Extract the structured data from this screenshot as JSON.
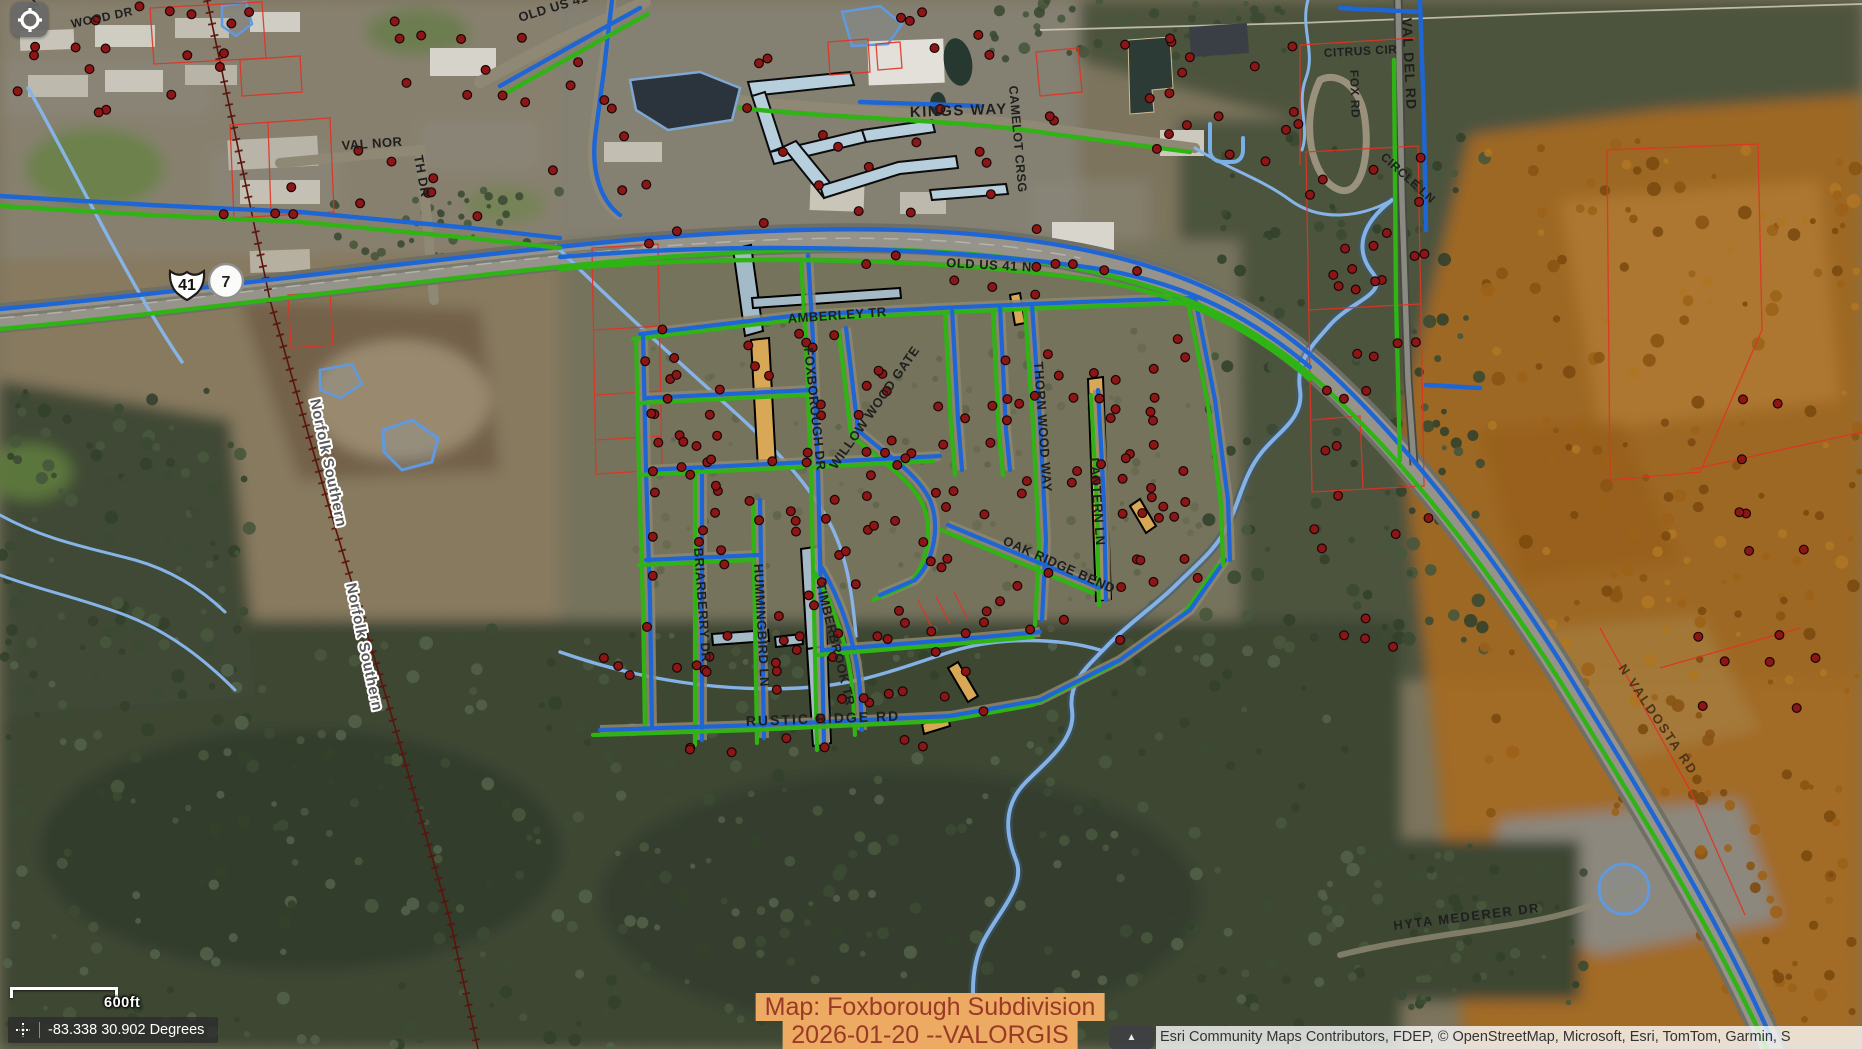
{
  "ui": {
    "locate_button": {
      "icon": "locate-crosshair-icon"
    },
    "scale_bar": {
      "label": "600ft"
    },
    "coordinates": {
      "icon": "crosshair-icon",
      "text": "-83.338 30.902 Degrees"
    },
    "map_stamp": {
      "line1": "Map: Foxborough Subdivision",
      "line2": "2026-01-20 --VALORGIS",
      "bg_color": "#edaa63",
      "text_color": "#9a3928"
    },
    "attribution": {
      "text": "Esri Community Maps Contributors, FDEP, © OpenStreetMap, Microsoft, Esri, TomTom, Garmin, S",
      "toggle_icon": "collapse-arrow-icon"
    }
  },
  "map": {
    "colors": {
      "parcel_red": "#e03324",
      "utility_blue": "#1e66d6",
      "utility_green": "#2fb315",
      "creek_blue": "#84b2e6",
      "address_dot": "#8c1616",
      "orange_zone": "#c67f28",
      "label": "#1f1f1f",
      "railroad": "#5a140e"
    },
    "shields": [
      {
        "type": "us-route-shield",
        "label": "41",
        "x": 187,
        "y": 284
      },
      {
        "type": "state-route-circle",
        "label": "7",
        "x": 226,
        "y": 281
      }
    ],
    "labels": [
      {
        "t": "KW",
        "x": 28,
        "y": 20,
        "r": -55,
        "s": 12
      },
      {
        "t": "WOOD DR",
        "x": 72,
        "y": 28,
        "r": -12,
        "s": 12
      },
      {
        "t": "OLD US 41 N",
        "x": 520,
        "y": 22,
        "r": -17,
        "s": 13
      },
      {
        "t": "VAL NOR",
        "x": 342,
        "y": 150,
        "r": -4,
        "s": 13
      },
      {
        "t": "TH DR",
        "x": 414,
        "y": 156,
        "r": 80,
        "s": 13
      },
      {
        "t": "KINGS WAY",
        "x": 910,
        "y": 117,
        "r": -2,
        "s": 15,
        "sp": 1.5
      },
      {
        "t": "CAMELOT CRSG",
        "x": 1009,
        "y": 86,
        "r": 85,
        "s": 12.5
      },
      {
        "t": "OLD US 41 N",
        "x": 946,
        "y": 267,
        "r": 3,
        "s": 13
      },
      {
        "t": "AMBERLEY TR",
        "x": 788,
        "y": 323,
        "r": -4,
        "s": 13
      },
      {
        "t": "FOXBOROUGH DR",
        "x": 804,
        "y": 348,
        "r": 84,
        "s": 13
      },
      {
        "t": "WILLOW WOOD GATE",
        "x": 836,
        "y": 470,
        "r": -55,
        "s": 13
      },
      {
        "t": "THORN WOOD WAY",
        "x": 1034,
        "y": 362,
        "r": 86,
        "s": 13
      },
      {
        "t": "LANTERN LN",
        "x": 1090,
        "y": 458,
        "r": 86,
        "s": 13
      },
      {
        "t": "OAK RIDGE BEND",
        "x": 1002,
        "y": 544,
        "r": 24,
        "s": 13
      },
      {
        "t": "RUSTIC RIDGE RD",
        "x": 746,
        "y": 726,
        "r": -2,
        "s": 14,
        "sp": 2
      },
      {
        "t": "BRIARBERRY DR",
        "x": 694,
        "y": 548,
        "r": 86,
        "s": 13
      },
      {
        "t": "HUMMINGBIRD LN",
        "x": 754,
        "y": 564,
        "r": 87,
        "s": 13
      },
      {
        "t": "TIMBERBROOK TR",
        "x": 816,
        "y": 584,
        "r": 76,
        "s": 13
      },
      {
        "t": "VAL DEL RD",
        "x": 1402,
        "y": 18,
        "r": 87,
        "s": 14,
        "sp": 1
      },
      {
        "t": "CITRUS CIR",
        "x": 1324,
        "y": 57,
        "r": -3,
        "s": 12
      },
      {
        "t": "FOX RD",
        "x": 1350,
        "y": 70,
        "r": 88,
        "s": 12
      },
      {
        "t": "CIRCLE LN",
        "x": 1380,
        "y": 158,
        "r": 42,
        "s": 12
      },
      {
        "t": "N VALDOSTA RD",
        "x": 1618,
        "y": 668,
        "r": 56,
        "s": 13,
        "sp": 2,
        "c": "#4d3318"
      },
      {
        "t": "HYTA MEDERER DR",
        "x": 1394,
        "y": 930,
        "r": -7,
        "s": 13,
        "sp": 1.5
      },
      {
        "t": "Norfolk Southern",
        "x": 310,
        "y": 400,
        "r": 78,
        "s": 15,
        "c": "#5a5a5a",
        "halo": true
      },
      {
        "t": "Norfolk Southern",
        "x": 346,
        "y": 584,
        "r": 78,
        "s": 15,
        "c": "#5a5a5a",
        "halo": true
      }
    ],
    "dot_zones": [
      {
        "x": 630,
        "y": 325,
        "w": 570,
        "h": 330,
        "n": 150,
        "seed": 11
      },
      {
        "x": 600,
        "y": 655,
        "w": 420,
        "h": 100,
        "n": 28,
        "seed": 22
      },
      {
        "x": 10,
        "y": 5,
        "w": 200,
        "h": 115,
        "n": 14,
        "seed": 33
      },
      {
        "x": 215,
        "y": 10,
        "w": 340,
        "h": 215,
        "n": 26,
        "seed": 44
      },
      {
        "x": 570,
        "y": 10,
        "w": 520,
        "h": 240,
        "n": 34,
        "seed": 55
      },
      {
        "x": 1090,
        "y": 35,
        "w": 210,
        "h": 130,
        "n": 18,
        "seed": 66
      },
      {
        "x": 1305,
        "y": 150,
        "w": 125,
        "h": 400,
        "n": 30,
        "seed": 77
      },
      {
        "x": 1690,
        "y": 380,
        "w": 165,
        "h": 330,
        "n": 14,
        "seed": 88
      },
      {
        "x": 1340,
        "y": 615,
        "w": 60,
        "h": 50,
        "n": 4,
        "seed": 99
      },
      {
        "x": 860,
        "y": 255,
        "w": 300,
        "h": 60,
        "n": 10,
        "seed": 12
      }
    ],
    "tree_zones": [
      {
        "x": 0,
        "y": 628,
        "w": 1360,
        "h": 420,
        "n": 420,
        "seed": 5,
        "rmin": 2.5,
        "rmax": 7,
        "colors": [
          "#3c4a33",
          "#47573c",
          "#33412b",
          "#52614a"
        ]
      },
      {
        "x": 1190,
        "y": 130,
        "w": 300,
        "h": 520,
        "n": 150,
        "seed": 6,
        "rmin": 2.5,
        "rmax": 7,
        "colors": [
          "#3c4a33",
          "#47573c",
          "#33412b"
        ]
      },
      {
        "x": 0,
        "y": 390,
        "w": 250,
        "h": 320,
        "n": 110,
        "seed": 7,
        "rmin": 2.5,
        "rmax": 7,
        "colors": [
          "#3c4a33",
          "#47573c",
          "#33412b"
        ]
      },
      {
        "x": 980,
        "y": 0,
        "w": 360,
        "h": 60,
        "n": 60,
        "seed": 8,
        "rmin": 2.5,
        "rmax": 6,
        "colors": [
          "#3c4a33",
          "#47573c"
        ]
      },
      {
        "x": 330,
        "y": 190,
        "w": 230,
        "h": 70,
        "n": 40,
        "seed": 9,
        "rmin": 2,
        "rmax": 5,
        "colors": [
          "#47573c",
          "#3c4a33"
        ]
      },
      {
        "x": 1480,
        "y": 140,
        "w": 382,
        "h": 680,
        "n": 200,
        "seed": 10,
        "rmin": 2.5,
        "rmax": 7,
        "colors": [
          "#9c6218",
          "#8a5414",
          "#ae7524",
          "#7c4a10"
        ]
      },
      {
        "x": 1700,
        "y": 820,
        "w": 162,
        "h": 200,
        "n": 40,
        "seed": 15,
        "rmin": 2.5,
        "rmax": 7,
        "colors": [
          "#9c6218",
          "#8a5414",
          "#7c4a10"
        ]
      },
      {
        "x": 1330,
        "y": 840,
        "w": 260,
        "h": 170,
        "n": 70,
        "seed": 13,
        "rmin": 2.5,
        "rmax": 6,
        "colors": [
          "#3c4a33",
          "#47573c",
          "#33412b"
        ]
      },
      {
        "x": 620,
        "y": 320,
        "w": 580,
        "h": 350,
        "n": 120,
        "seed": 14,
        "rmin": 2,
        "rmax": 5,
        "op": 0.5,
        "colors": [
          "#5b6647",
          "#4d5a3e"
        ]
      }
    ]
  }
}
